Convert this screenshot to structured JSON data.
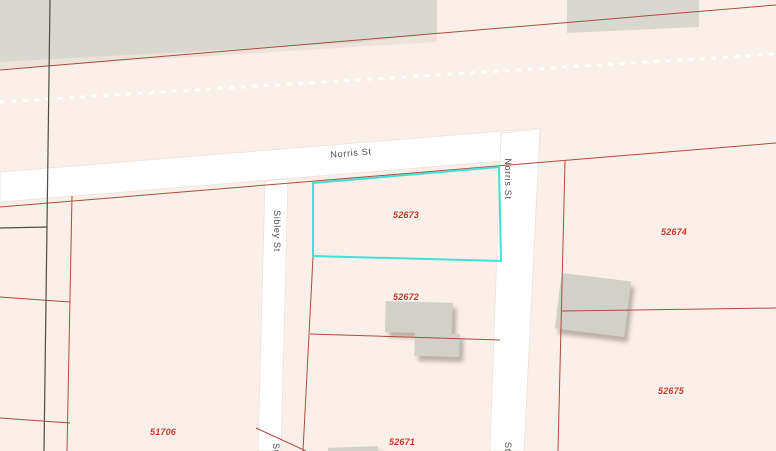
{
  "map": {
    "type": "parcel-map-view",
    "highlighted_parcel": "52673",
    "parcel_labels": [
      {
        "text": "52673"
      },
      {
        "text": "52674"
      },
      {
        "text": "52672"
      },
      {
        "text": "52675"
      },
      {
        "text": "52671"
      },
      {
        "text": "51706"
      }
    ],
    "street_labels": [
      {
        "text": "Norris St"
      },
      {
        "text": "Norris St"
      },
      {
        "text": "Sibley St"
      },
      {
        "text": "St"
      },
      {
        "text": "St"
      }
    ]
  },
  "colors": {
    "parcel_fill": "#faf0e9",
    "road_fill": "#ffffff",
    "block_gray": "#d9d8d0",
    "building_gray": "#d2d1c9",
    "parcel_line_red": "#b04a3e",
    "boundary_dark": "#4f4b47",
    "highlight_cyan": "#42e0d4",
    "parcel_label_red": "#c63a2d",
    "street_label_gray": "#4c4c4c",
    "dashed_line_white": "#ffffff"
  }
}
